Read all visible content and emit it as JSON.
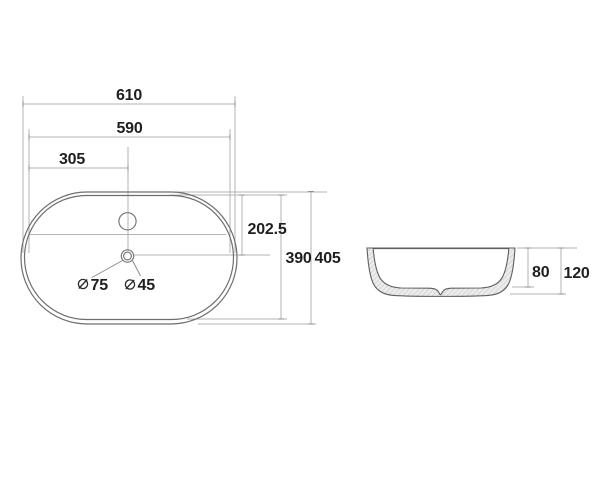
{
  "drawing": {
    "kind": "washbasin-dimension-drawing",
    "top_view": {
      "dims": {
        "overall_width": "610",
        "inner_width": "590",
        "center_offset": "305",
        "top_to_drain": "202.5",
        "inner_depth": "390",
        "overall_depth": "405"
      },
      "holes": [
        {
          "diameter": "75"
        },
        {
          "diameter": "45"
        }
      ]
    },
    "side_view": {
      "dims": {
        "bowl_depth": "80",
        "overall_height": "120"
      }
    },
    "colors": {
      "background": "#ffffff",
      "dimension_lines": "#b3b3b3",
      "object_outline": "#6e6e6e",
      "text": "#1f1f1f",
      "section_hatch": "#c2c2c2"
    }
  }
}
